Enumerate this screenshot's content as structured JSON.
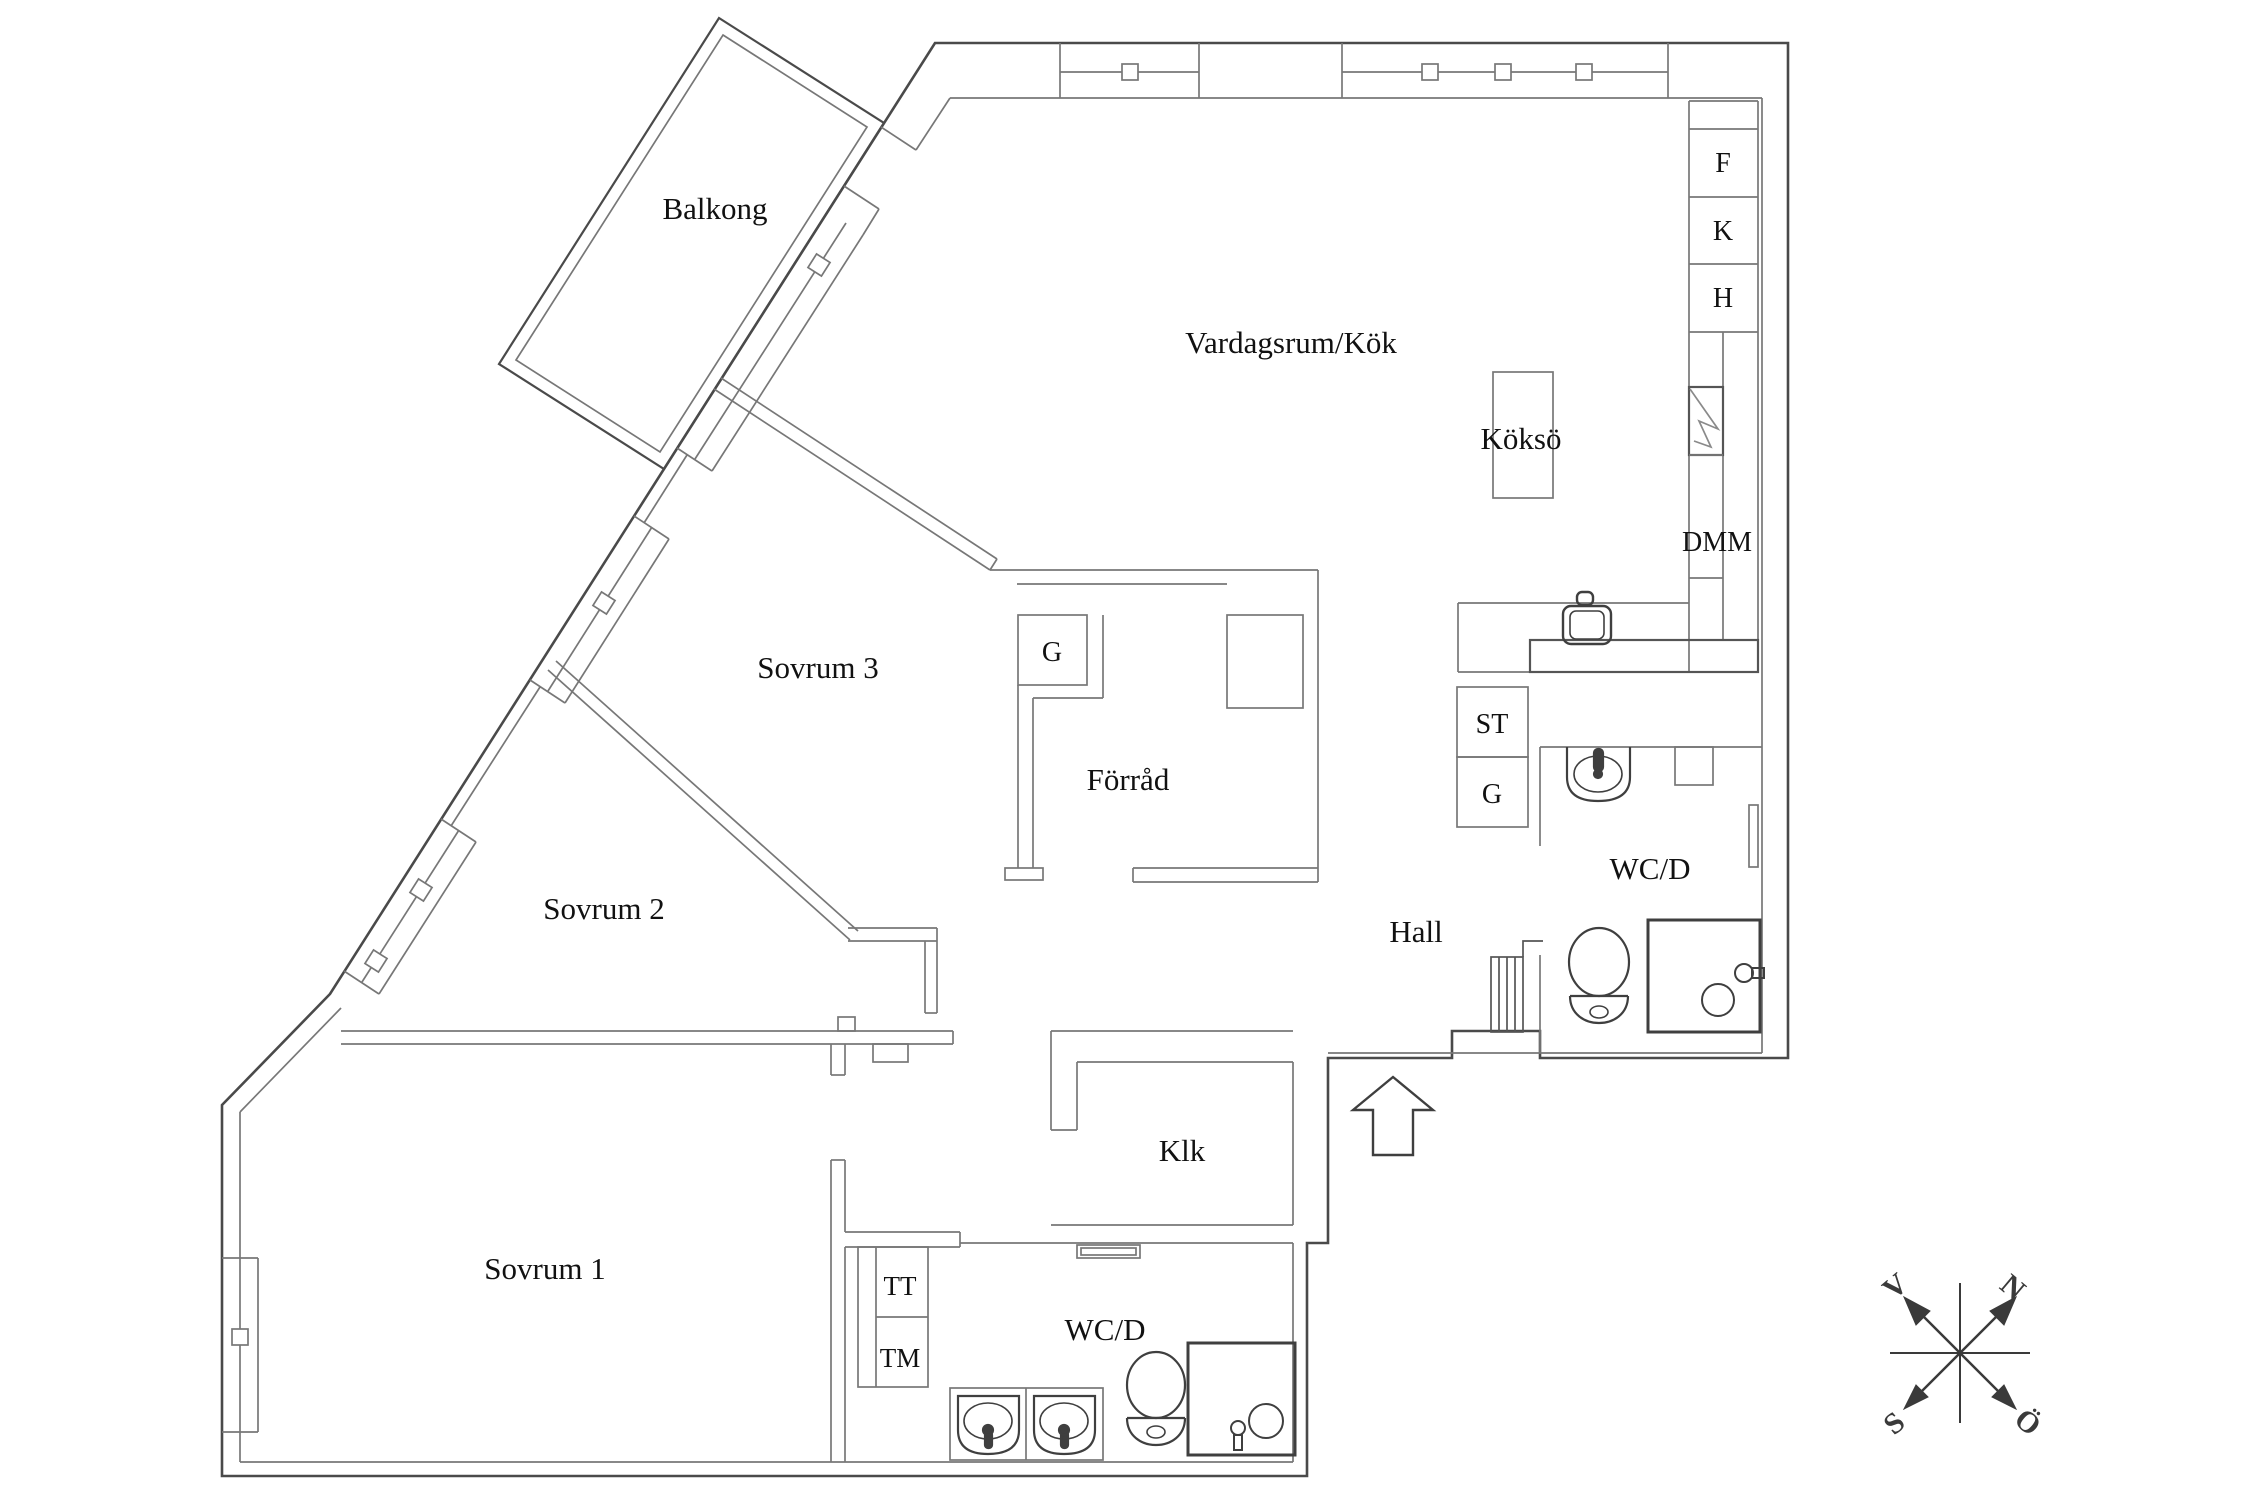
{
  "rooms": {
    "balcony": "Balkong",
    "living": "Vardagsrum/Kök",
    "island": "Köksö",
    "bedroom3": "Sovrum 3",
    "storage": "Förråd",
    "bedroom2": "Sovrum 2",
    "bedroom1": "Sovrum 1",
    "hall": "Hall",
    "wc_upper": "WC/D",
    "wc_lower": "WC/D",
    "klk": "Klk"
  },
  "units": {
    "freezer": "F",
    "fridge": "K",
    "tall_cabinet": "H",
    "dishwasher": "DMM",
    "st_closet": "ST",
    "wardrobe_hall": "G",
    "wardrobe_bedroom3": "G",
    "dryer": "TT",
    "washer": "TM"
  },
  "compass": {
    "north": "N",
    "east": "Ö",
    "south": "S",
    "west": "V"
  },
  "colors": {
    "outer_wall": "#4a4a4a",
    "inner_wall": "#777777",
    "fixture": "#3f3f3f",
    "text": "#111111",
    "background": "#ffffff"
  }
}
